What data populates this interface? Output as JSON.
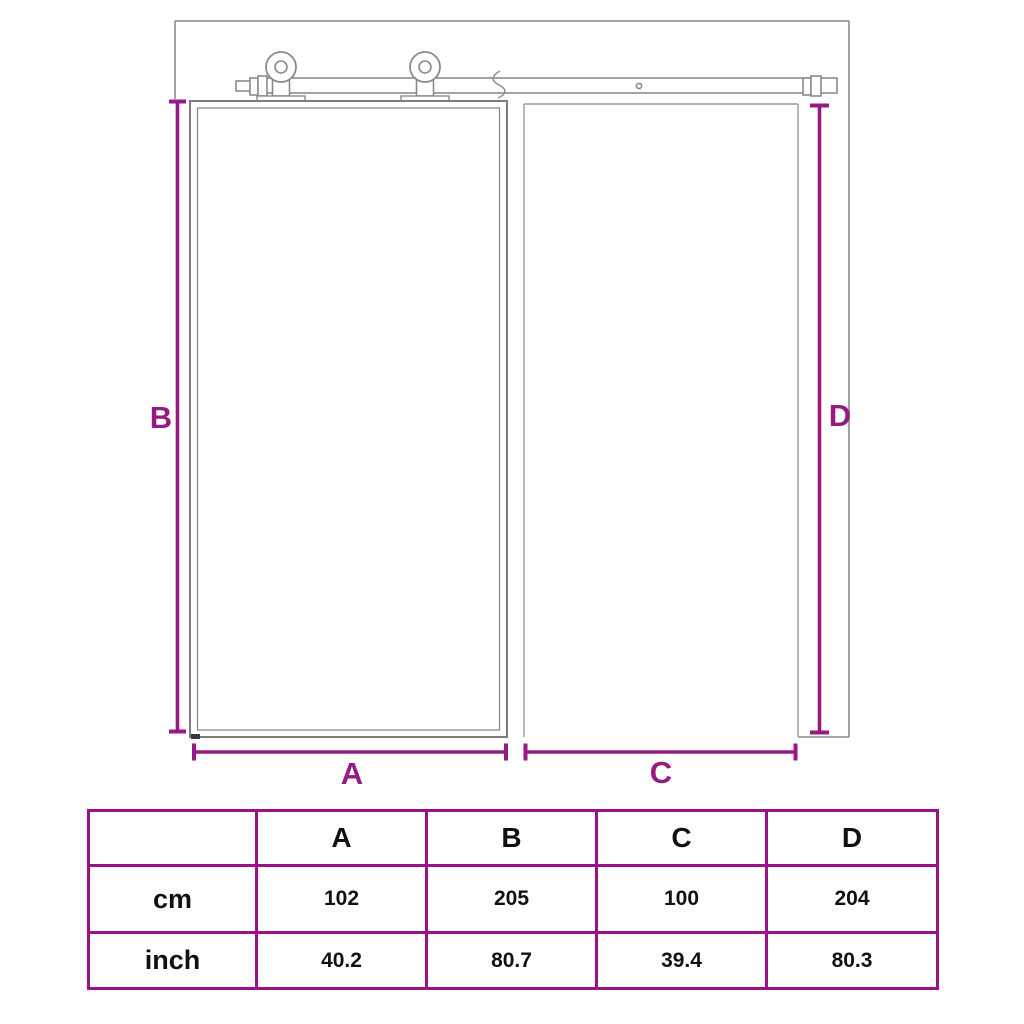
{
  "diagram": {
    "labels": {
      "a": "A",
      "b": "B",
      "c": "C",
      "d": "D"
    },
    "parts": [
      "wall-outline",
      "sliding-rail",
      "roller-wheels",
      "door-panel",
      "doorway-opening"
    ]
  },
  "table": {
    "headers": [
      "",
      "A",
      "B",
      "C",
      "D"
    ],
    "rows": [
      {
        "label": "cm",
        "values": [
          "102",
          "205",
          "100",
          "204"
        ]
      },
      {
        "label": "inch",
        "values": [
          "40.2",
          "80.7",
          "39.4",
          "80.3"
        ]
      }
    ]
  },
  "colors": {
    "accent": "#951B81",
    "table_border": "#9B1187",
    "line_gray": "#8A8A8A",
    "text": "#111111"
  }
}
